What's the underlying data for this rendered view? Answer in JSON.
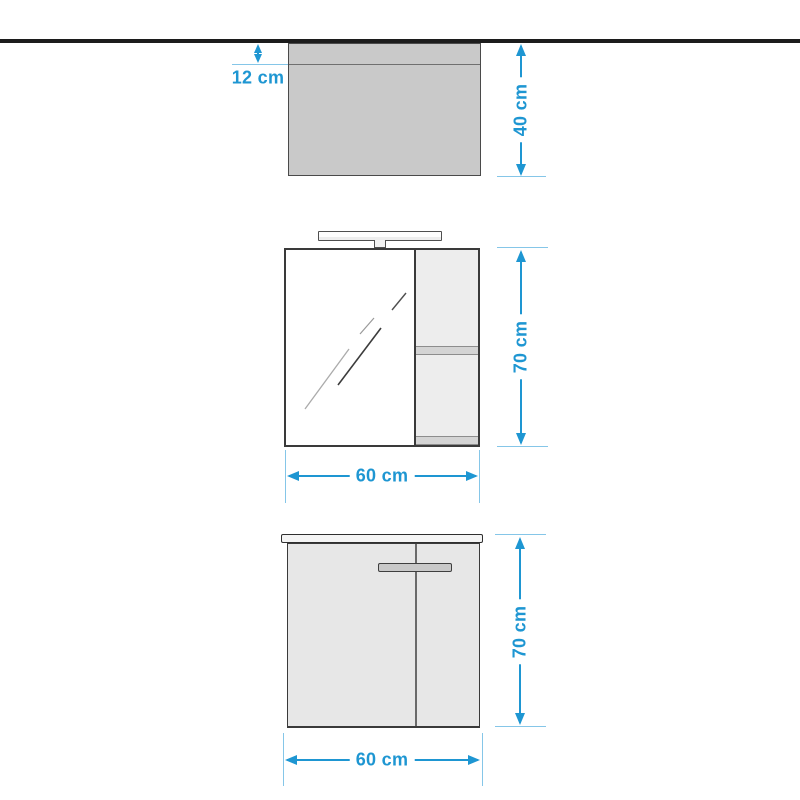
{
  "colors": {
    "accent": "#1e96d2",
    "extension_line": "#85c6e8",
    "wall_line": "#1c1c1c",
    "panel_fill": "#c9c9c9",
    "cabinet_fill": "#e7e7e7"
  },
  "diagram": {
    "top_view": {
      "gap_label": "12 cm",
      "depth_label": "40 cm"
    },
    "mirror_cabinet": {
      "height_label": "70 cm",
      "width_label": "60 cm"
    },
    "base_cabinet": {
      "height_label": "70 cm",
      "width_label": "60 cm"
    }
  }
}
